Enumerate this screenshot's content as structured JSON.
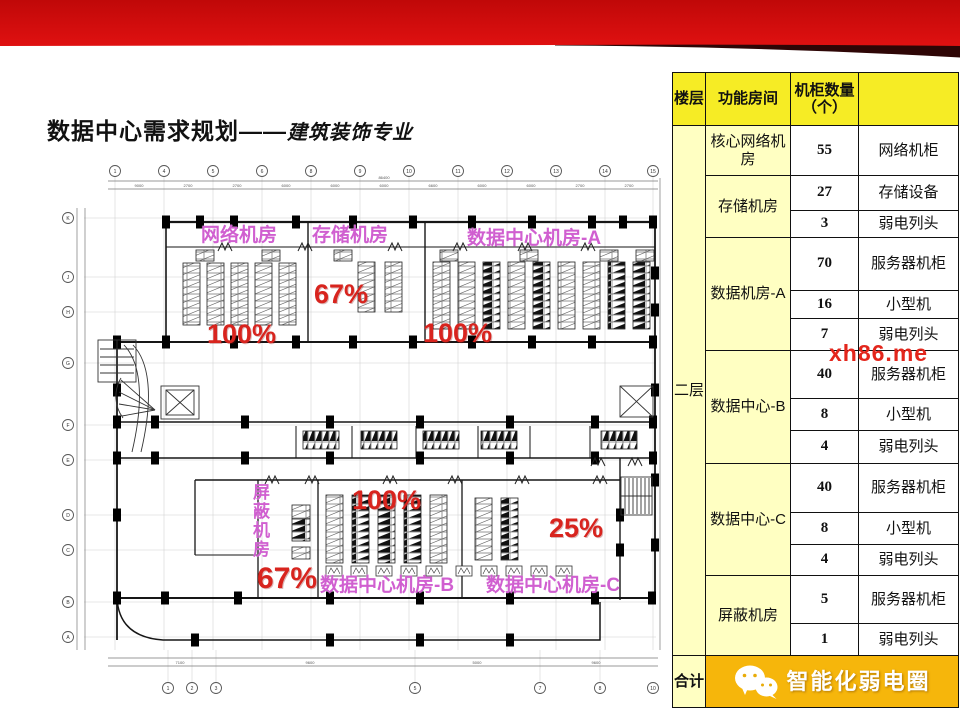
{
  "banner": {
    "red": "#cb0b0b",
    "dark": "#2e0606"
  },
  "title": {
    "main": "数据中心需求规划——",
    "sub": "建筑装饰专业"
  },
  "watermark": {
    "text": "xh86.me",
    "color": "#e3261c"
  },
  "floorplan": {
    "rooms": {
      "network": "网络机房",
      "storage": "存储机房",
      "dc_a": "数据中心机房-A",
      "dc_b": "数据中心机房-B",
      "dc_c": "数据中心机房-C",
      "shield": "屏蔽机房"
    },
    "occupancy": {
      "network": "100%",
      "storage": "67%",
      "dc_a": "100%",
      "dc_b": "100%",
      "dc_c": "25%",
      "shield": "67%"
    },
    "label_color": "#d05fd0",
    "occupancy_color": "#d8241e",
    "grid_top": [
      "1",
      "4",
      "5",
      "6",
      "8",
      "9",
      "10",
      "11",
      "12",
      "13",
      "14",
      "15"
    ],
    "grid_left": [
      "K",
      "J",
      "H",
      "G",
      "F",
      "E",
      "D",
      "C",
      "B",
      "A"
    ],
    "grid_bottom": [
      "1",
      "2",
      "3",
      "5",
      "7",
      "8",
      "10"
    ],
    "dims_top": [
      "9000",
      "2700",
      "2700",
      "6000",
      "6000",
      "6000",
      "6600",
      "6000",
      "6000",
      "2700",
      "2700"
    ],
    "dims_top_total": "86400",
    "dims_bottom": [
      "7100",
      "9600",
      "5000",
      "9600"
    ]
  },
  "table": {
    "headers": [
      "楼层",
      "功能房间",
      "机柜数量（个）",
      ""
    ],
    "floor": "二层",
    "rooms": [
      "核心网络机房",
      "存储机房",
      "数据机房-A",
      "数据中心-B",
      "数据中心-C",
      "屏蔽机房"
    ],
    "rows": [
      {
        "qty": "55",
        "name": "网络机柜"
      },
      {
        "qty": "27",
        "name": "存储设备"
      },
      {
        "qty": "3",
        "name": "弱电列头"
      },
      {
        "qty": "70",
        "name": "服务器机柜"
      },
      {
        "qty": "16",
        "name": "小型机"
      },
      {
        "qty": "7",
        "name": "弱电列头"
      },
      {
        "qty": "40",
        "name": "服务器机柜"
      },
      {
        "qty": "8",
        "name": "小型机"
      },
      {
        "qty": "4",
        "name": "弱电列头"
      },
      {
        "qty": "40",
        "name": "服务器机柜"
      },
      {
        "qty": "8",
        "name": "小型机"
      },
      {
        "qty": "4",
        "name": "弱电列头"
      },
      {
        "qty": "5",
        "name": "服务器机柜"
      },
      {
        "qty": "1",
        "name": "弱电列头"
      }
    ],
    "total_label": "合计"
  },
  "footer_brand": {
    "name": "智能化弱电圈"
  }
}
